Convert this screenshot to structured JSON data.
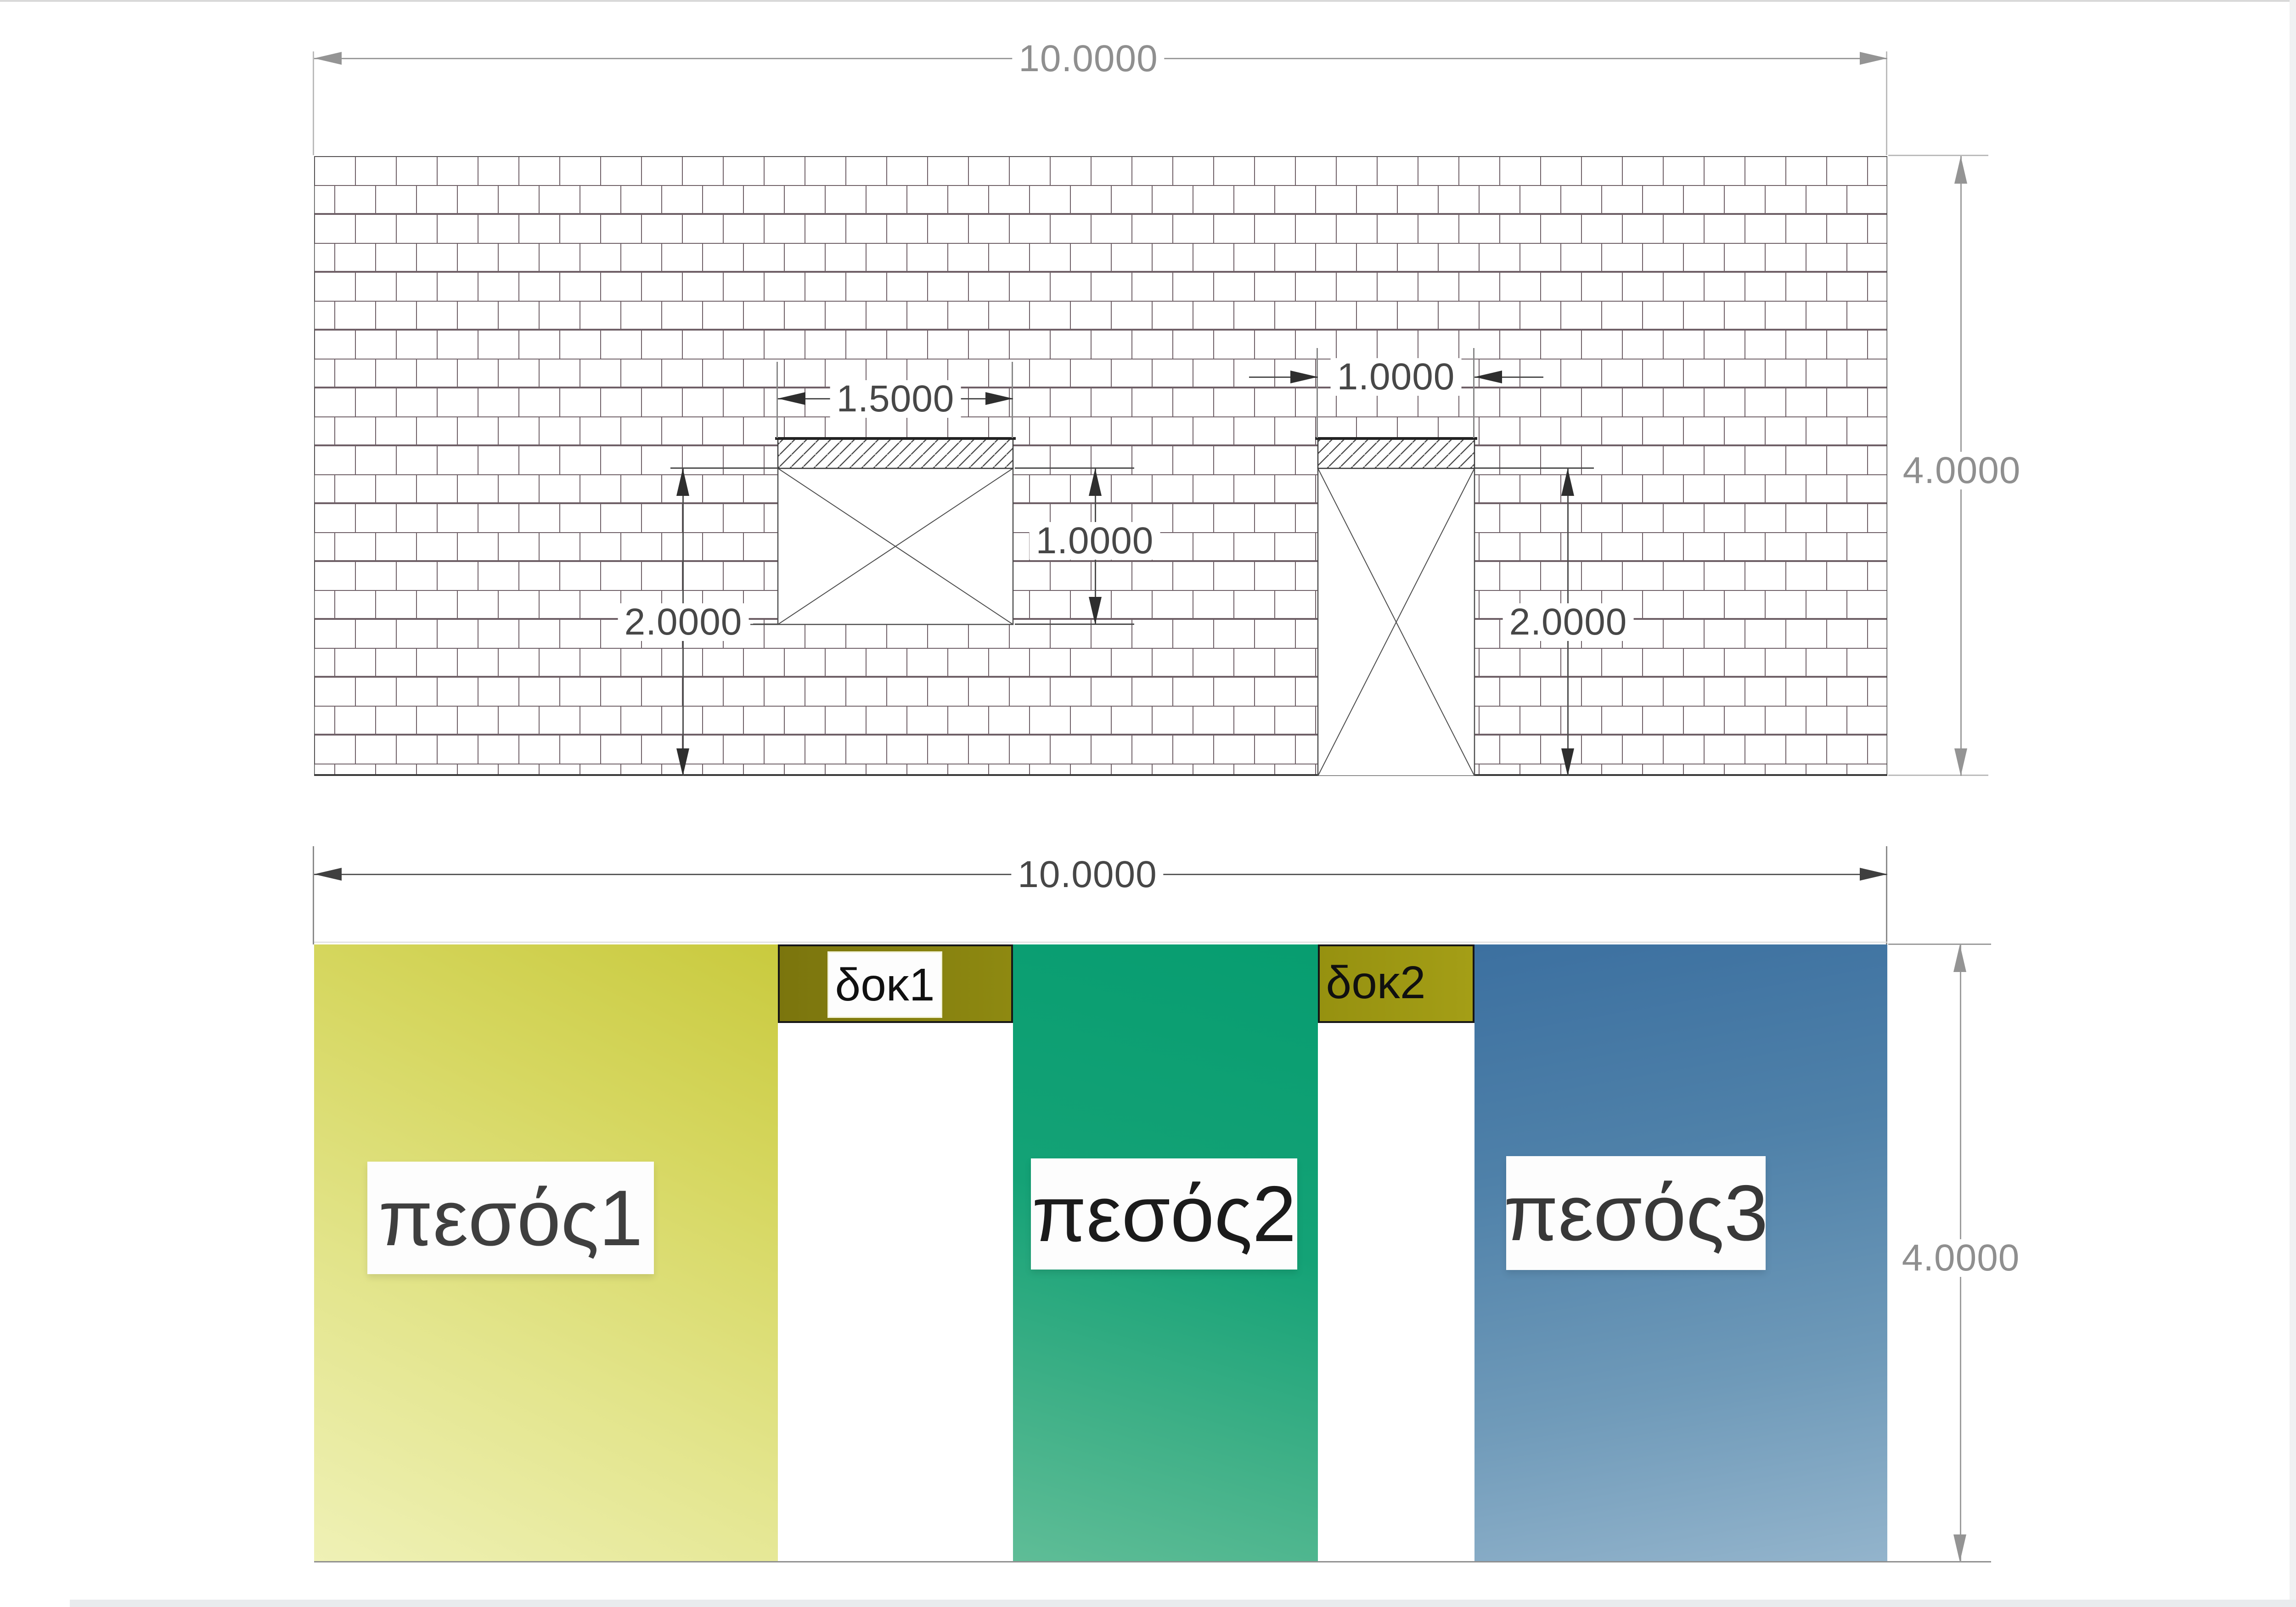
{
  "view": {
    "title": "masonry-wall-structural-view",
    "language": "el"
  },
  "wall_elevation": {
    "dim_total_width": "10.0000",
    "dim_total_height": "4.0000",
    "window": {
      "dim_width": "1.5000",
      "dim_height": "1.0000"
    },
    "window_top_to_base": "2.0000",
    "door": {
      "dim_width": "1.0000",
      "dim_height": "2.0000"
    }
  },
  "pier_diagram": {
    "dim_total_width": "10.0000",
    "dim_total_height": "4.0000",
    "piers": [
      {
        "label": "πεσός1",
        "color_dark": "#c9ca3e",
        "color_light": "#eff1b6"
      },
      {
        "label": "πεσός2",
        "color_dark": "#079d70",
        "color_light": "#5fbd97"
      },
      {
        "label": "πεσός3",
        "color_dark": "#3c70a0",
        "color_light": "#93b4cc"
      }
    ],
    "beams": [
      {
        "label": "δοκ1",
        "color": "#837d10"
      },
      {
        "label": "δοκ2",
        "color": "#9c9613"
      }
    ]
  },
  "colors": {
    "dim_annotation_light": "#949494",
    "dim_annotation_dark": "#2e2e2e",
    "brick_joint": "#6f6067",
    "wall_outline": "#4a4a4a",
    "beam_border": "#161616"
  }
}
